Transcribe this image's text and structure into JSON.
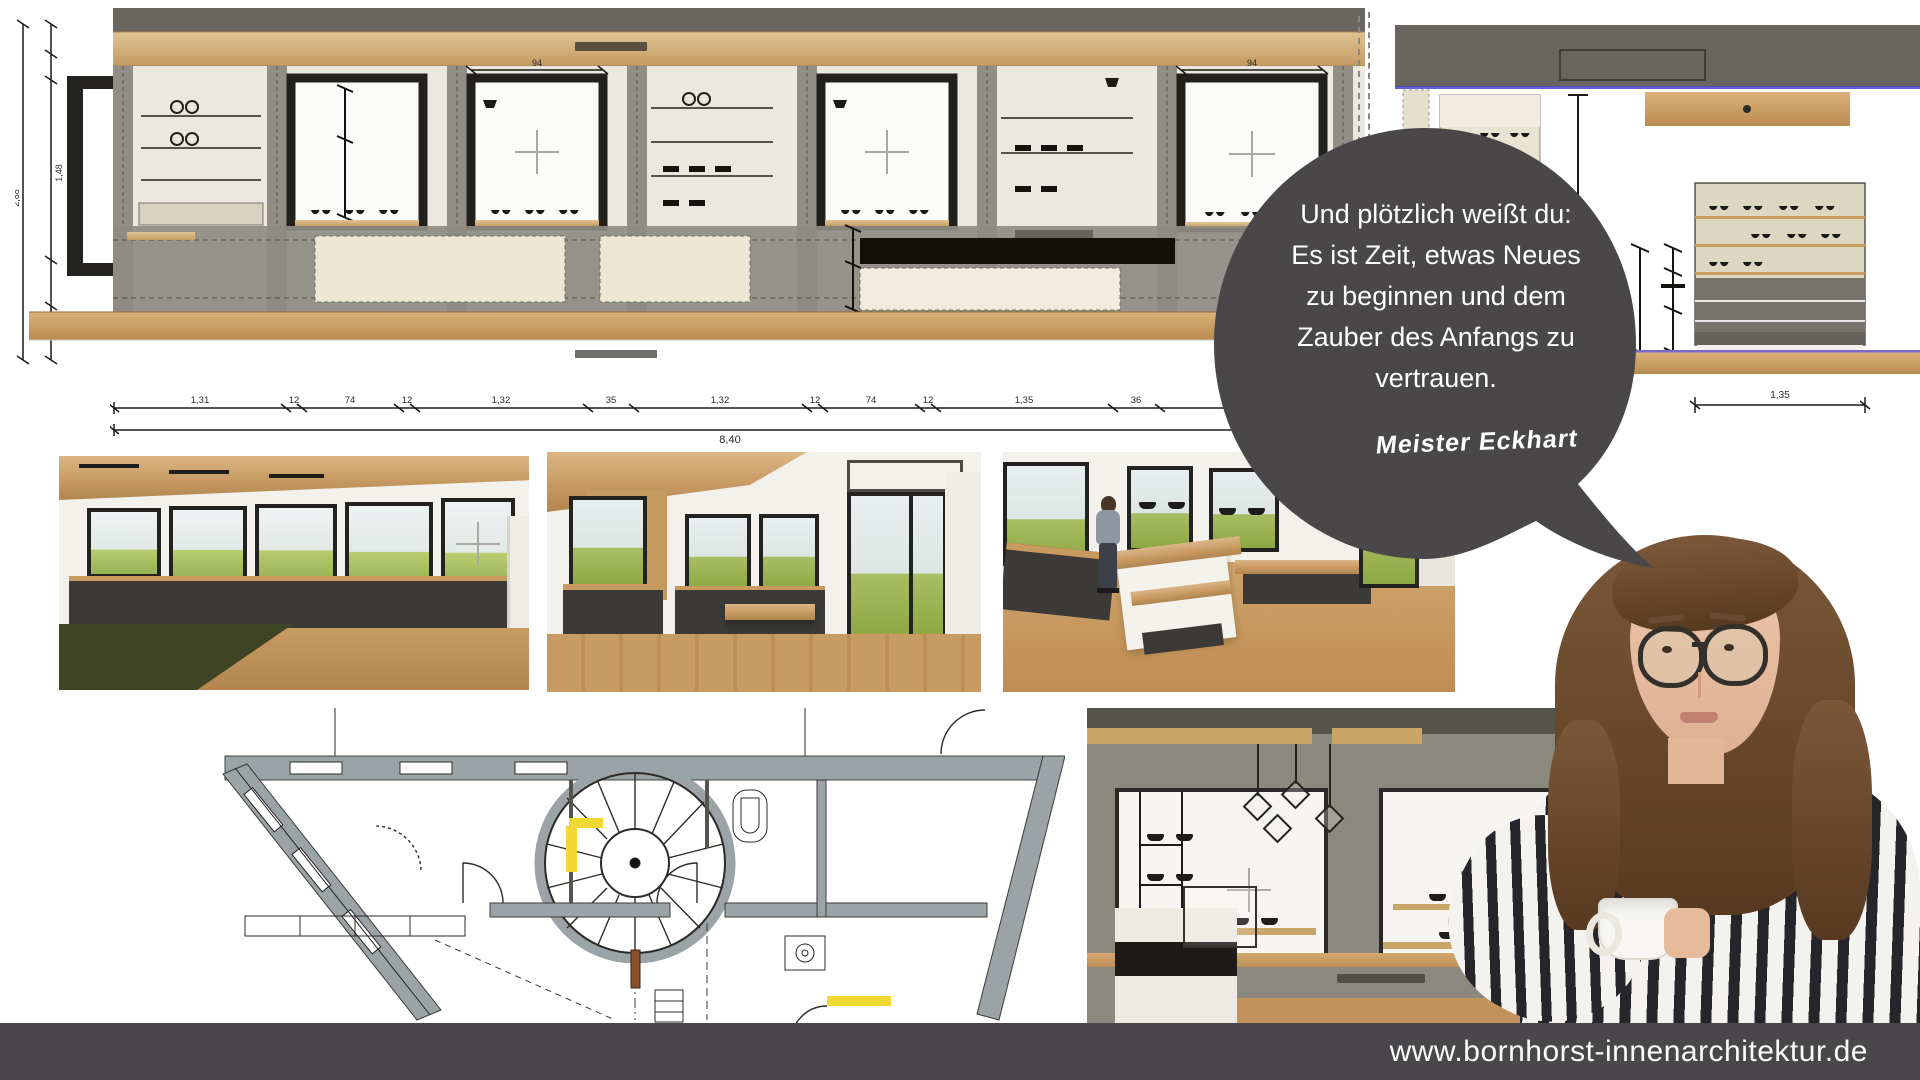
{
  "site": {
    "url": "www.bornhorst-innenarchitektur.de"
  },
  "quote": {
    "lines": [
      "Und plötzlich weißt du:",
      "Es ist Zeit, etwas Neues",
      "zu beginnen und dem",
      "Zauber des Anfangs zu",
      "vertrauen."
    ],
    "attribution": "Meister Eckhart"
  },
  "elevation_main": {
    "left_total_dim": "2,88",
    "left_window_dim": "1,48",
    "window_width_dims": [
      "94",
      "94"
    ],
    "dim_chain": [
      "1,31",
      "12",
      "74",
      "12",
      "1,32",
      "35",
      "1,32",
      "12",
      "74",
      "12",
      "1,35",
      "36",
      "1,51"
    ],
    "dim_total": "8,40"
  },
  "elevation_right": {
    "height_dim": "1,19",
    "width_dim": "1,35"
  },
  "palette": {
    "bubble_gray": "#4a4749",
    "bottom_bar_gray": "#49474a",
    "wood_light": "#d9b98a",
    "wood_floor": "#c08c52",
    "frame_dark": "#232220",
    "plan_wall_gray": "#9aa3a6",
    "highlight_yellow": "#f2d832",
    "grass_green": "#9ab257",
    "anthracite": "#3b3a37",
    "blue_line": "#4a45c8",
    "purple_line": "#7b68c8"
  }
}
